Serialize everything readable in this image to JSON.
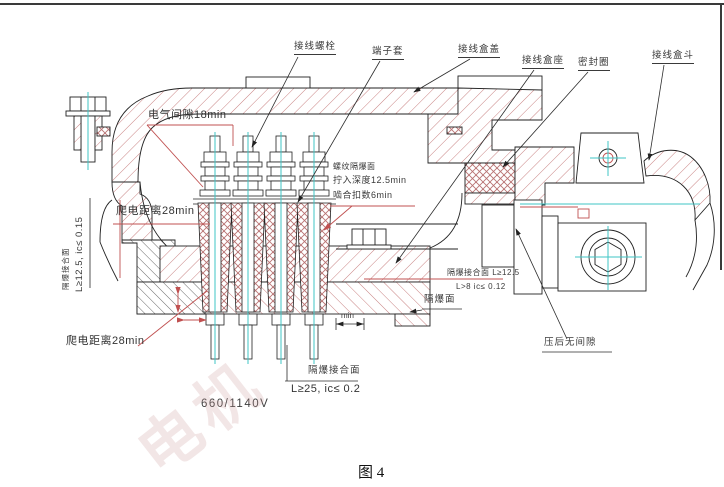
{
  "figure": {
    "caption": "图 4",
    "voltage_rating": "660/1140V",
    "watermark": "电机"
  },
  "part_labels": {
    "terminal_bolt": "接线螺栓",
    "terminal_sleeve": "端子套",
    "box_cover": "接线盒盖",
    "box_seat": "接线盒座",
    "seal_ring": "密封圈",
    "box_hopper": "接线盒斗"
  },
  "annotations": {
    "electrical_clearance": "电气间隙18min",
    "creepage_distance_upper": "爬电距离28min",
    "creepage_distance_lower": "爬电距离28min",
    "thread_flameproof_line1": "螺纹隔爆面",
    "thread_flameproof_line2": "拧入深度12.5min",
    "thread_flameproof_line3": "啮合扣数6min",
    "left_joint_name": "隔爆接合面",
    "left_joint_spec": "L≥12.5, ic≤ 0.15",
    "spigot_joint_spec_line1": "隔爆接合面 L≥12.5",
    "spigot_joint_spec_line2": "L>8  ic≤ 0.12",
    "flameproof_surface": "隔爆面",
    "no_gap_after_pressing": "压后无间隙",
    "bottom_joint_name": "隔爆接合面",
    "bottom_joint_spec": "L≥25, ic≤ 0.2",
    "min_dimension": "min"
  },
  "colors": {
    "hatch_red": "#c98383",
    "cross_hatch_red": "#b87272",
    "centerline_cyan": "#3fc6c6",
    "dimension_red": "#c05050",
    "outline": "#222222"
  }
}
